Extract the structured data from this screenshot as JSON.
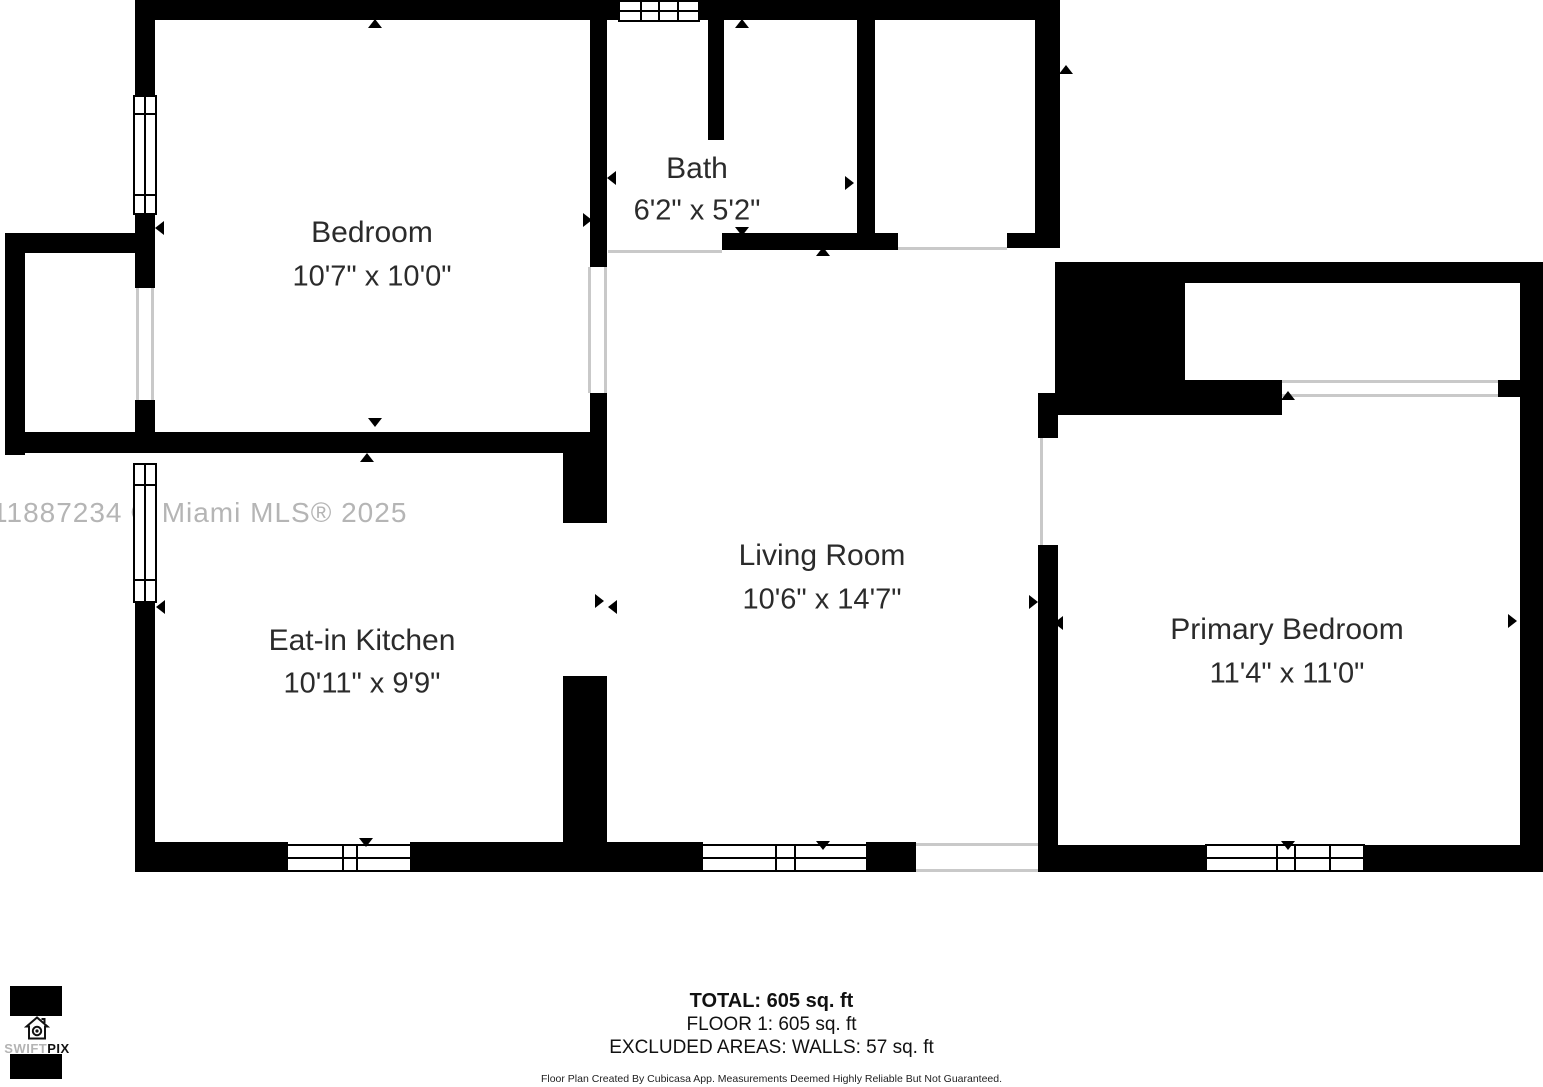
{
  "watermark": "11887234 © Miami MLS® 2025",
  "floorplan": {
    "rooms": [
      {
        "name": "Bedroom",
        "dimensions": "10'7\" x 10'0\""
      },
      {
        "name": "Bath",
        "dimensions": "6'2\" x 5'2\""
      },
      {
        "name": "Eat-in Kitchen",
        "dimensions": "10'11\" x 9'9\""
      },
      {
        "name": "Living Room",
        "dimensions": "10'6\" x 14'7\""
      },
      {
        "name": "Primary Bedroom",
        "dimensions": "11'4\" x 11'0\""
      }
    ]
  },
  "footer": {
    "total": "TOTAL: 605 sq. ft",
    "floor": "FLOOR 1: 605 sq. ft",
    "excluded": "EXCLUDED AREAS: WALLS: 57 sq. ft",
    "disclaimer": "Floor Plan Created By Cubicasa App. Measurements Deemed Highly Reliable But Not Guaranteed."
  },
  "logo": {
    "prefix": "SWIFT",
    "suffix": "PIX"
  },
  "colors": {
    "wall": "#000000",
    "label": "#2b2b2b",
    "watermark": "#b5b5b5",
    "opening_line": "#c9c9c9"
  }
}
